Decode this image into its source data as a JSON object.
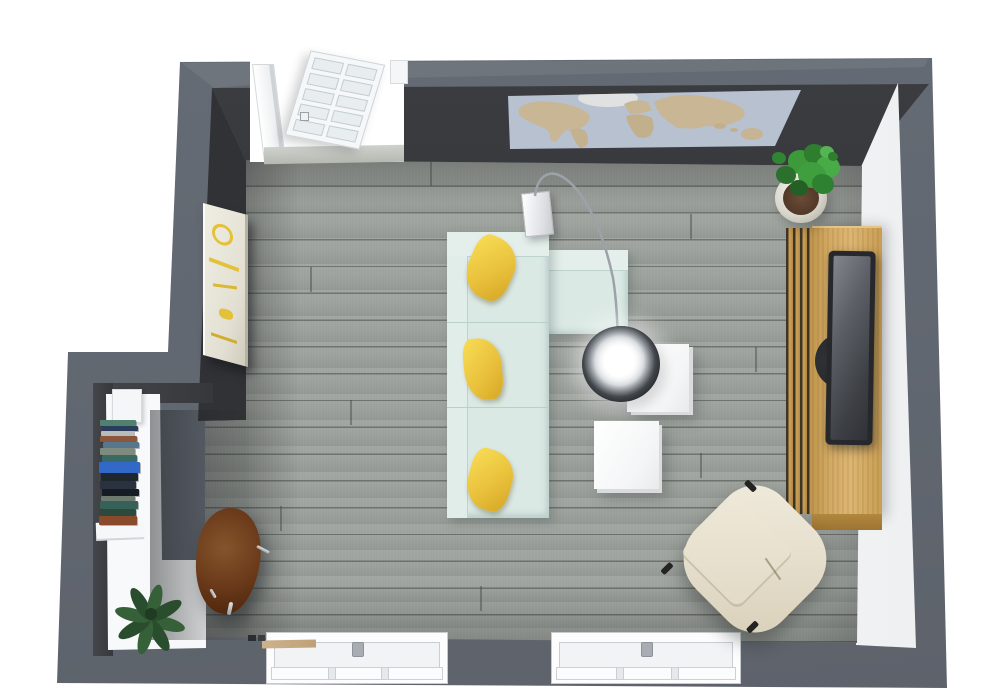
{
  "scene": {
    "kind": "3d-floor-plan-top-view",
    "room": "living-room",
    "background": "#FFFFFF"
  },
  "palette": {
    "wall_outer": "#666C75",
    "wall_face_dark": "#303236",
    "wall_face_light": "#F6F7F9",
    "floor": "#9BA09B",
    "sofa": "#DBE9E5",
    "sofa_back": "#E4EFEB",
    "pillow_yellow": "#EAC23C",
    "cube_table": "#F4F5F6",
    "lamp_chrome": "#43474C",
    "console_wood": "#D3AA64",
    "console_slat": "#3F3526",
    "tv_frame": "#26282B",
    "map_ocean": "#B7C1D0",
    "map_land": "#C8B695",
    "art_accent": "#E3C23A",
    "desk_white": "#FAFBFC",
    "chair_brown": "#6E3D1C",
    "plant_green": "#3C9A3B",
    "plant_dark_green": "#356038",
    "pot": "#D9D6CD",
    "armchair_cream": "#E7E0CF",
    "window_frame": "#FDFDFE",
    "sill_wood": "#CDB28C"
  },
  "inventory": [
    {
      "item": "l-shaped-sectional-sofa",
      "count": 1
    },
    {
      "item": "yellow-throw-pillow",
      "count": 3
    },
    {
      "item": "white-cube-side-table",
      "count": 2
    },
    {
      "item": "arc-floor-lamp",
      "count": 1
    },
    {
      "item": "tv-media-console",
      "count": 1
    },
    {
      "item": "flatscreen-tv",
      "count": 1
    },
    {
      "item": "potted-plant-large",
      "count": 1
    },
    {
      "item": "potted-plant-small",
      "count": 1
    },
    {
      "item": "cream-armchair",
      "count": 1
    },
    {
      "item": "brown-leather-chair",
      "count": 1
    },
    {
      "item": "white-desk-shelf",
      "count": 1
    },
    {
      "item": "book-stack",
      "count": 15
    },
    {
      "item": "world-map-wall-art",
      "count": 1
    },
    {
      "item": "abstract-canvas-art",
      "count": 1
    },
    {
      "item": "glazed-door",
      "count": 1
    },
    {
      "item": "window",
      "count": 2
    }
  ],
  "books": [
    {
      "top": 420,
      "left": 100,
      "width": 36,
      "height": 6,
      "color": "#51806F"
    },
    {
      "top": 426,
      "left": 102,
      "width": 36,
      "height": 5,
      "color": "#2C3C5C"
    },
    {
      "top": 431,
      "left": 101,
      "width": 33,
      "height": 5,
      "color": "#B9BDB9"
    },
    {
      "top": 436,
      "left": 100,
      "width": 37,
      "height": 6,
      "color": "#8C563C"
    },
    {
      "top": 442,
      "left": 103,
      "width": 36,
      "height": 6,
      "color": "#57788C"
    },
    {
      "top": 448,
      "left": 100,
      "width": 35,
      "height": 7,
      "color": "#7E8B7E"
    },
    {
      "top": 455,
      "left": 102,
      "width": 35,
      "height": 7,
      "color": "#3A6A64"
    },
    {
      "top": 462,
      "left": 99,
      "width": 41,
      "height": 11,
      "color": "#3268C8"
    },
    {
      "top": 473,
      "left": 101,
      "width": 37,
      "height": 8,
      "color": "#20262E"
    },
    {
      "top": 481,
      "left": 100,
      "width": 36,
      "height": 8,
      "color": "#2A3240"
    },
    {
      "top": 489,
      "left": 102,
      "width": 37,
      "height": 7,
      "color": "#171C24"
    },
    {
      "top": 496,
      "left": 101,
      "width": 34,
      "height": 5,
      "color": "#6E7A70"
    },
    {
      "top": 501,
      "left": 100,
      "width": 38,
      "height": 8,
      "color": "#356158"
    },
    {
      "top": 509,
      "left": 102,
      "width": 34,
      "height": 7,
      "color": "#2C4A3C"
    },
    {
      "top": 516,
      "left": 99,
      "width": 38,
      "height": 9,
      "color": "#8A4A2C"
    }
  ]
}
